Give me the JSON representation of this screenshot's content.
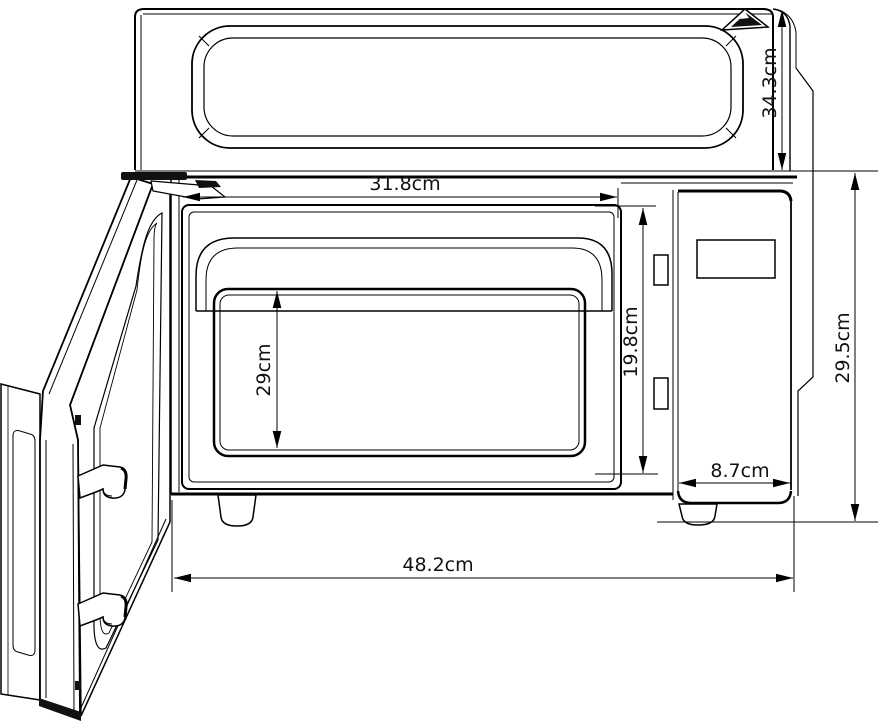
{
  "diagram": {
    "type": "technical-drawing",
    "subject": "Microwave oven with open door - external and cavity dimensions",
    "unit": "cm",
    "labels": {
      "cavity_width": "31.8cm",
      "top_section_height": "34.3cm",
      "inner_opening_height": "29cm",
      "cavity_height": "19.8cm",
      "front_height": "29.5cm",
      "control_panel_width": "8.7cm",
      "overall_width": "48.2cm"
    },
    "icons": {
      "brand_logo": "mountain-triangle-icon"
    },
    "colors": {
      "line": "#000000",
      "background": "#ffffff",
      "text": "#111111"
    }
  }
}
